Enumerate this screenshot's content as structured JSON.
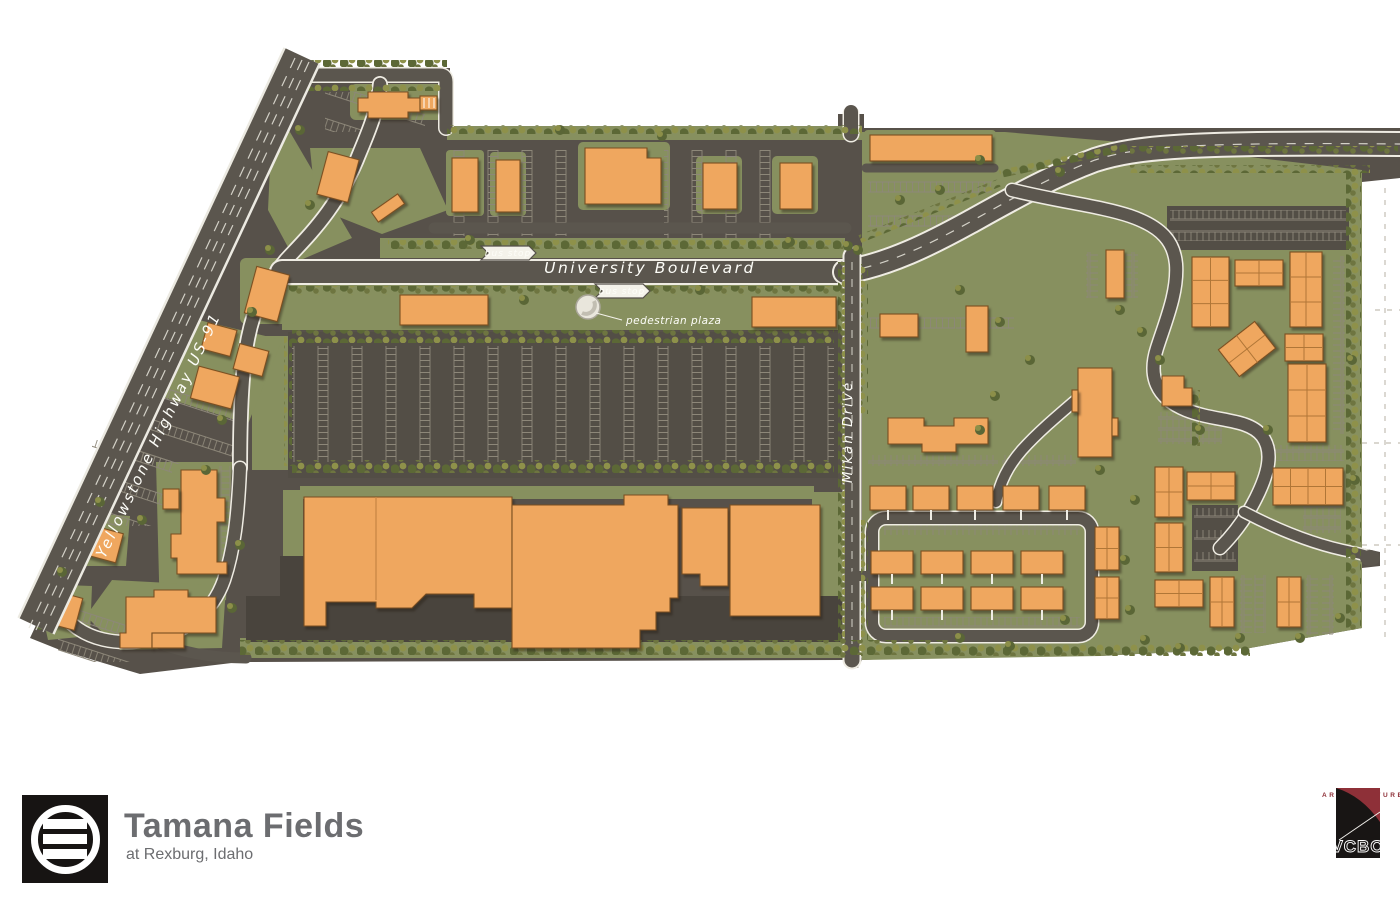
{
  "map": {
    "road_labels": {
      "highway": "Yellowstone Highway US-91",
      "boulevard": "University Boulevard",
      "drive": "Mikan Drive"
    },
    "poi": {
      "bus_stop_north": "bus stop",
      "bus_stop_south": "bus stop",
      "pedestrian_plaza": "pedestrian plaza"
    },
    "colors": {
      "building": "#efa75f",
      "landscape": "#87905f",
      "asphalt": "#57514a",
      "road_edge": "#efece3"
    }
  },
  "footer": {
    "project_name": "Tamana Fields",
    "project_location": "at Rexburg, Idaho",
    "firm_name": "VCBO",
    "firm_tagline": "ARCHITECTURE",
    "firm_accent": "#8e3038"
  }
}
